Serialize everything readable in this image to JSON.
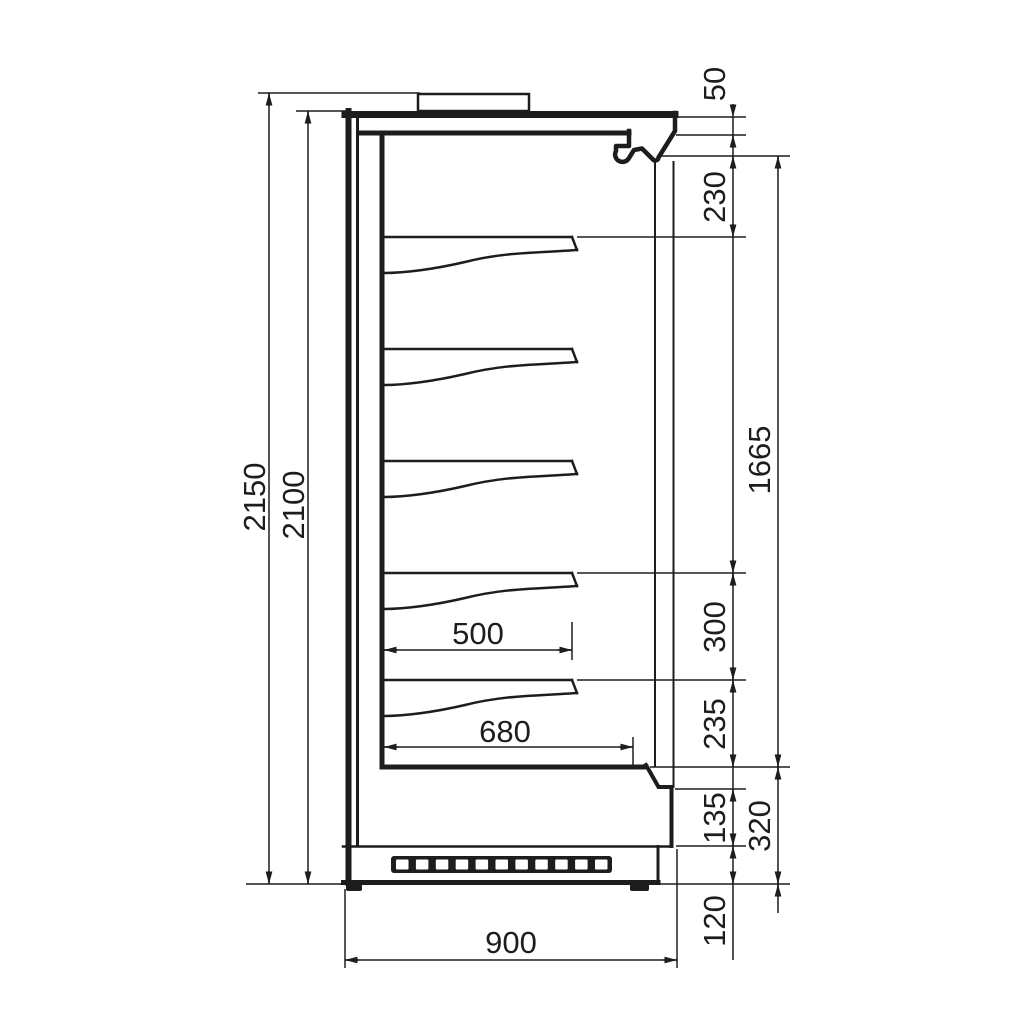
{
  "drawing": {
    "type": "technical-side-section-view",
    "background": "#ffffff",
    "line_color": "#1d1d1b",
    "shelf_count": 5,
    "dimensions": {
      "overall_height": "2150",
      "cabinet_height": "2100",
      "top_panel": "50",
      "canopy_to_first_shelf": "230",
      "display_opening_height": "1665",
      "shelf_pitch": "300",
      "shelf_to_deck": "235",
      "front_panel_height": "135",
      "deck_to_floor": "320",
      "plinth_height": "120",
      "shelf_depth": "500",
      "deck_depth": "680",
      "overall_depth": "900"
    }
  }
}
